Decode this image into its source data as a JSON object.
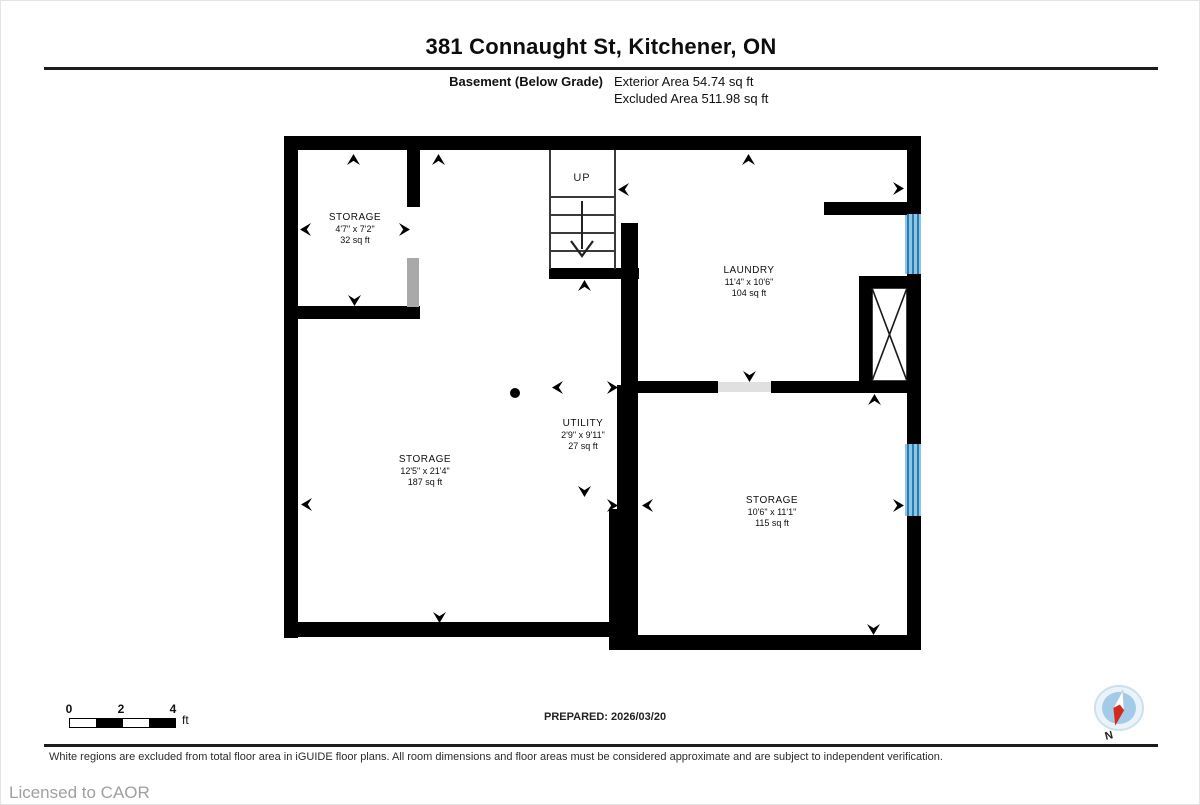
{
  "header": {
    "title": "381 Connaught St, Kitchener, ON",
    "floor_label": "Basement (Below Grade)",
    "exterior_area": "Exterior Area 54.74 sq ft",
    "excluded_area": "Excluded Area 511.98 sq ft"
  },
  "rooms": [
    {
      "name": "STORAGE",
      "dimensions": "4'7\" x 7'2\"",
      "area": "32 sq ft"
    },
    {
      "name": "LAUNDRY",
      "dimensions": "11'4\" x 10'6\"",
      "area": "104 sq ft"
    },
    {
      "name": "UTILITY",
      "dimensions": "2'9\" x 9'11\"",
      "area": "27 sq ft"
    },
    {
      "name": "STORAGE",
      "dimensions": "12'5\" x 21'4\"",
      "area": "187 sq ft"
    },
    {
      "name": "STORAGE",
      "dimensions": "10'6\" x 11'1\"",
      "area": "115 sq ft"
    }
  ],
  "stairs": {
    "label": "UP"
  },
  "scale_bar": {
    "ticks": [
      "0",
      "2",
      "4"
    ],
    "unit": "ft"
  },
  "footer": {
    "prepared": "PREPARED: 2026/03/20",
    "disclaimer": "White regions are excluded from total floor area in iGUIDE floor plans. All room dimensions and floor areas must be considered approximate and are subject to independent verification.",
    "license": "Licensed to CAOR"
  },
  "compass": {
    "label": "N"
  },
  "colors": {
    "wall": "#000000",
    "window_fill": "#8cc6e6",
    "window_stripe": "#2e7cab",
    "door_gray": "#a9a9a9",
    "opening_gray": "#e0e0e0",
    "compass_blue": "#a3cbe7",
    "compass_red": "#d3281c"
  }
}
